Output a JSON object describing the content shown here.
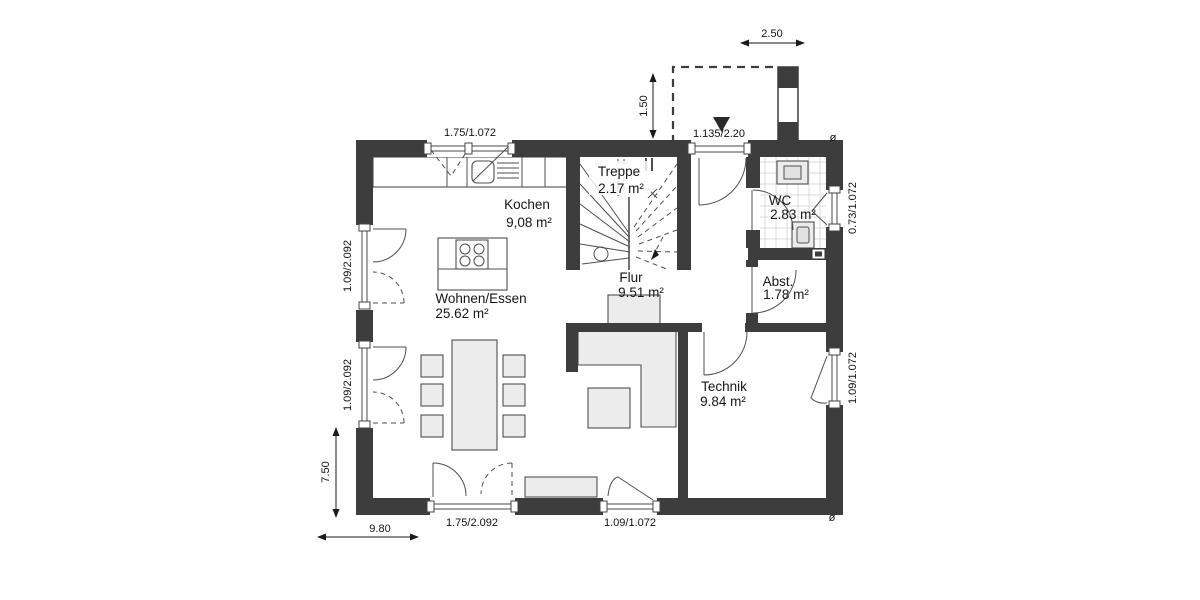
{
  "rooms": [
    {
      "name": "Kochen",
      "area": "9,08 m²"
    },
    {
      "name": "Treppe",
      "area": "2.17 m²"
    },
    {
      "name": "WC",
      "area": "2.83 m²"
    },
    {
      "name": "Flur",
      "area": "9.51 m²"
    },
    {
      "name": "Abst.",
      "area": "1.78 m²"
    },
    {
      "name": "Wohnen/Essen",
      "area": "25.62 m²"
    },
    {
      "name": "Technik",
      "area": "9.84 m²"
    }
  ],
  "dimensions": {
    "kitchen_window": "1.75/1.072",
    "canopy_width": "2.50",
    "canopy_depth": "1.50",
    "entrance_door": "1.135/2.20",
    "wc_window": "0.73/1.072",
    "left_window_upper": "1.09/2.092",
    "left_window_lower": "1.09/2.092",
    "technik_window": "1.09/1.072",
    "plan_depth": "7.50",
    "plan_width": "9.80",
    "terrace_door": "1.75/2.092",
    "south_window": "1.09/1.072"
  },
  "symbols": {
    "downpipe": "ø"
  },
  "colors": {
    "wall": "#3d3d3d",
    "furniture": "#ececec",
    "text": "#161616"
  }
}
